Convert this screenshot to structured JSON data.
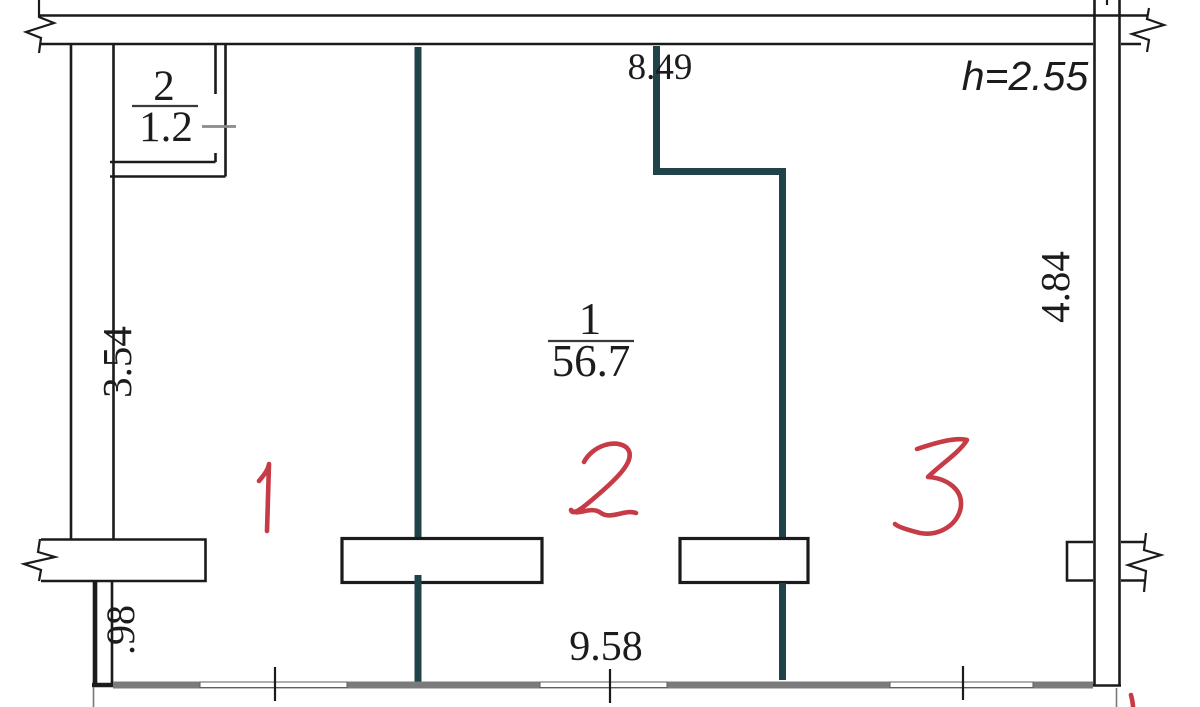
{
  "drawing": {
    "rooms": [
      {
        "number": "1",
        "area": "56.7"
      },
      {
        "number": "2",
        "area": "1.2"
      }
    ],
    "handwritten_marks": {
      "zone1": "1",
      "zone2": "2",
      "zone3": "3"
    },
    "dimensions": {
      "top_width": "8.49",
      "ceiling_height": "h=2.55",
      "left_wall": "3.54",
      "right_wall": "4.84",
      "bottom_width": "9.58",
      "lower_left_wall": ".98"
    }
  },
  "colors": {
    "wall": "#1b1b1b",
    "partition": "#1f4348",
    "sill": "#7b7b7b",
    "annotation": "#c63b45",
    "ink": "#1c1c1c",
    "paper": "#ffffff"
  }
}
